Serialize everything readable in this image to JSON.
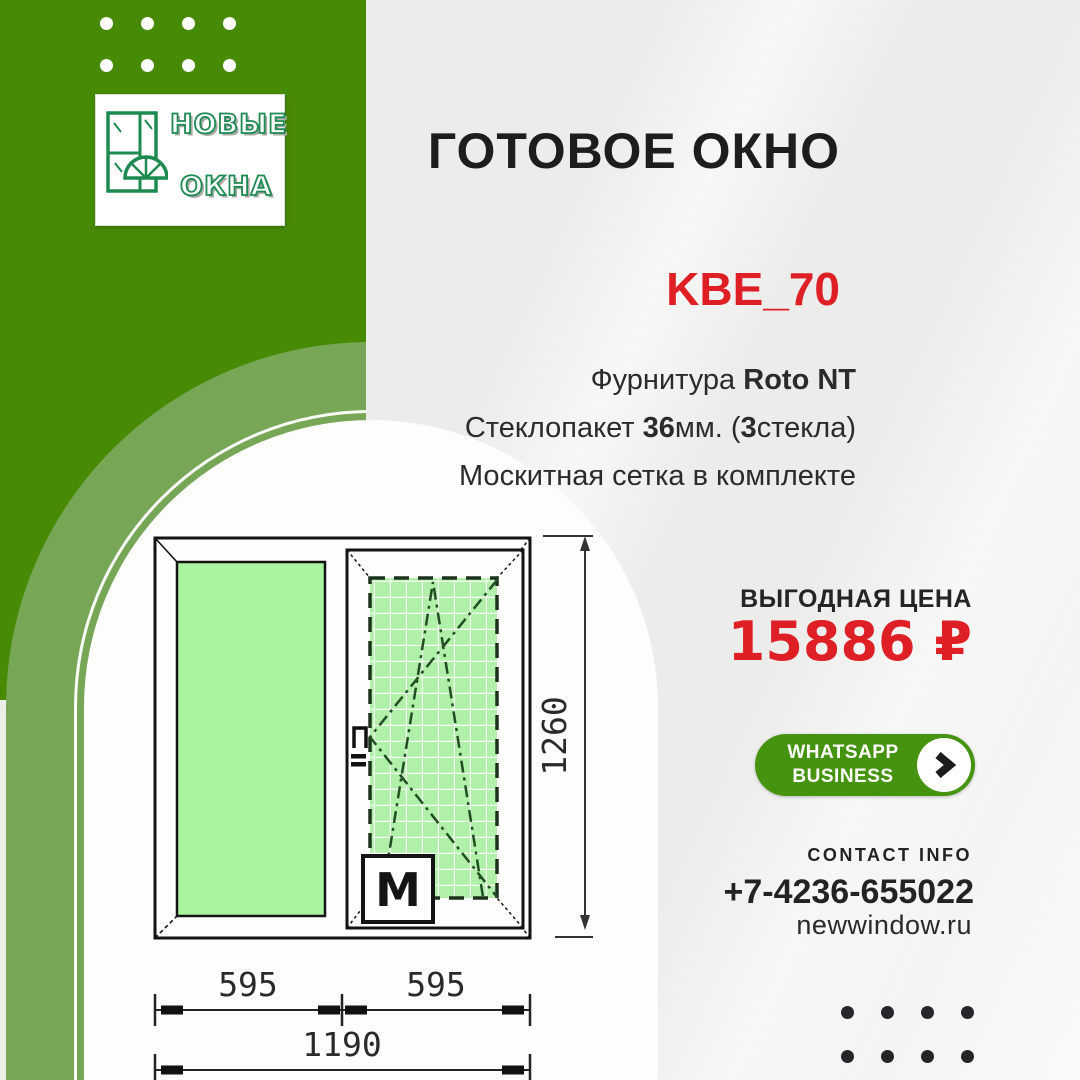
{
  "logo": {
    "word1": "НОВЫЕ",
    "word2": "ОКНА"
  },
  "header": {
    "title": "ГОТОВОЕ ОКНО",
    "model": "KBE_70"
  },
  "features": {
    "line1_normal": "Фурнитура ",
    "line1_bold": "Roto NT",
    "line2_pre": "Стеклопакет ",
    "line2_bold1": "36",
    "line2_mid": "мм. (",
    "line2_bold2": "3",
    "line2_post": "стекла)",
    "line3": "Москитная сетка в комплекте"
  },
  "price": {
    "label": "ВЫГОДНАЯ ЦЕНА",
    "value": "15886 ₽"
  },
  "cta": {
    "line1": "WHATSAPP",
    "line2": "BUSINESS",
    "icon": "chevron-right"
  },
  "contact": {
    "heading": "CONTACT INFO",
    "phone": "+7-4236-655022",
    "website": "newwindow.ru"
  },
  "drawing": {
    "dim_left": "595",
    "dim_right": "595",
    "dim_total": "1190",
    "dim_height": "1260",
    "mosquito_label": "M"
  },
  "colors": {
    "brand_green": "#478a04",
    "band_green": "#77a756",
    "accent_red": "#df1f26",
    "cta_green": "#46930f",
    "glass_green": "#a9f3a1",
    "net_green": "#b0f0a8"
  }
}
